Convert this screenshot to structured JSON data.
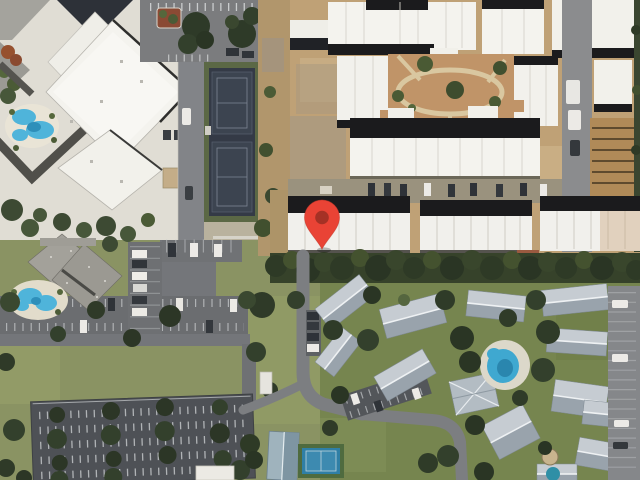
{
  "map": {
    "view_mode": "satellite",
    "aria_label": "Satellite aerial map view with a red location marker over a white-roofed apartment building row"
  },
  "marker": {
    "icon": "map-pin-icon",
    "fill": "#E94335",
    "dot": "#A53125",
    "outline": "#C4392A",
    "tip_x_px": 322,
    "tip_y_px": 249
  },
  "palette": {
    "grass": "#8A9363",
    "grass_south": "#76854F",
    "sand": "#E0DDD4",
    "roof_white": "#F4F3EE",
    "roof_black": "#1B1B1D",
    "roof_gray_light": "#C6CCD2",
    "roof_gray_dark": "#99A3AC",
    "asphalt": "#7A7B7D",
    "asphalt_dark": "#4E5156",
    "dirt": "#BFA176",
    "courtyard_dirt": "#C09468",
    "pool_blue": "#4FB4DA",
    "pool_south": "#3FA8D0",
    "tennis_navy": "#3C4450",
    "tennis_blue": "#2F7FA6",
    "tree_dark": "#2E3A26",
    "hedge": "#36422A"
  },
  "features": [
    {
      "name": "resort-complex",
      "kind": "building"
    },
    {
      "name": "resort-pool",
      "kind": "pool"
    },
    {
      "name": "north-parking",
      "kind": "parking"
    },
    {
      "name": "north-road",
      "kind": "road"
    },
    {
      "name": "tennis-courts-north",
      "kind": "sports-court"
    },
    {
      "name": "construction-complex",
      "kind": "building"
    },
    {
      "name": "construction-courtyard",
      "kind": "ground"
    },
    {
      "name": "marked-building-row",
      "kind": "building"
    },
    {
      "name": "tree-hedge",
      "kind": "vegetation"
    },
    {
      "name": "southwest-building",
      "kind": "building"
    },
    {
      "name": "southwest-pool",
      "kind": "pool"
    },
    {
      "name": "southwest-parking-lots",
      "kind": "parking"
    },
    {
      "name": "south-residential-complex",
      "kind": "building"
    },
    {
      "name": "south-pool",
      "kind": "pool"
    },
    {
      "name": "tennis-court-south",
      "kind": "sports-court"
    },
    {
      "name": "access-road-south",
      "kind": "road"
    },
    {
      "name": "east-parking-lane",
      "kind": "parking"
    },
    {
      "name": "location-marker",
      "kind": "marker"
    }
  ]
}
